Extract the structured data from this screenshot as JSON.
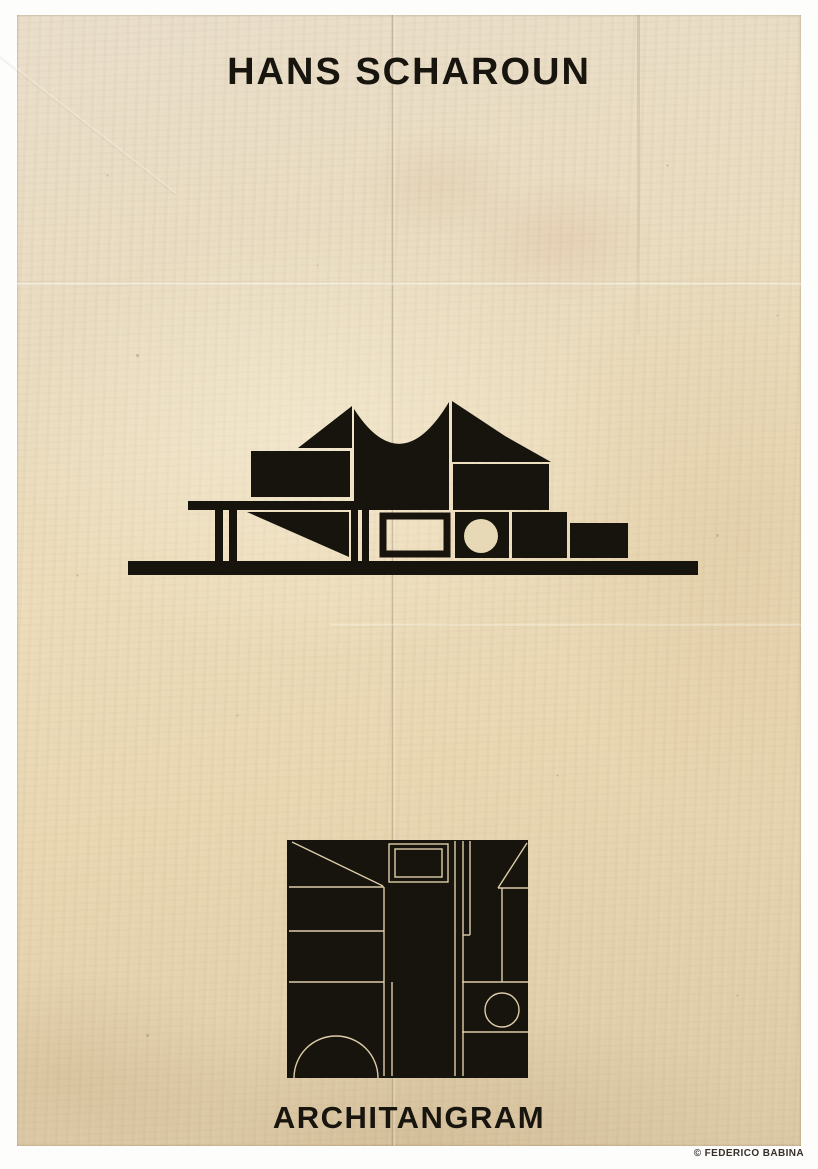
{
  "poster": {
    "title": "HANS SCHAROUN",
    "series_title": "ARCHITANGRAM",
    "credit": "© FEDERICO BABINA",
    "colors": {
      "page_background": "#ffffff",
      "paper": "#e9dcbd",
      "paper_edge_shadow": "#d9c8a5",
      "ink": "#17130d",
      "plan_line_on_ink": "#ddcda9",
      "credit_text": "#35302a",
      "stain_pink": "#cd8c76"
    },
    "illustrations": {
      "building": {
        "name": "berlin-philharmonie-silhouette",
        "description": "Abstract black geometric side elevation of Hans Scharoun's Berlin Philharmonie: concave tent roof with two peaks, stacked rectangular volumes, a framed square window, a square with a circular porthole, a table slab on thin pilotis legs, a sloped wedge, and a long ground line"
      },
      "tangram": {
        "name": "architangram-plan-tile",
        "description": "Solid black square tile with thin paper-coloured plan lines: top-left diagonal, nested rectangles, parallel corridors, stepped horizontals, a small circle and a semicircular arc on the bottom edge, with a diagonal cut at the top-right corner"
      }
    }
  }
}
